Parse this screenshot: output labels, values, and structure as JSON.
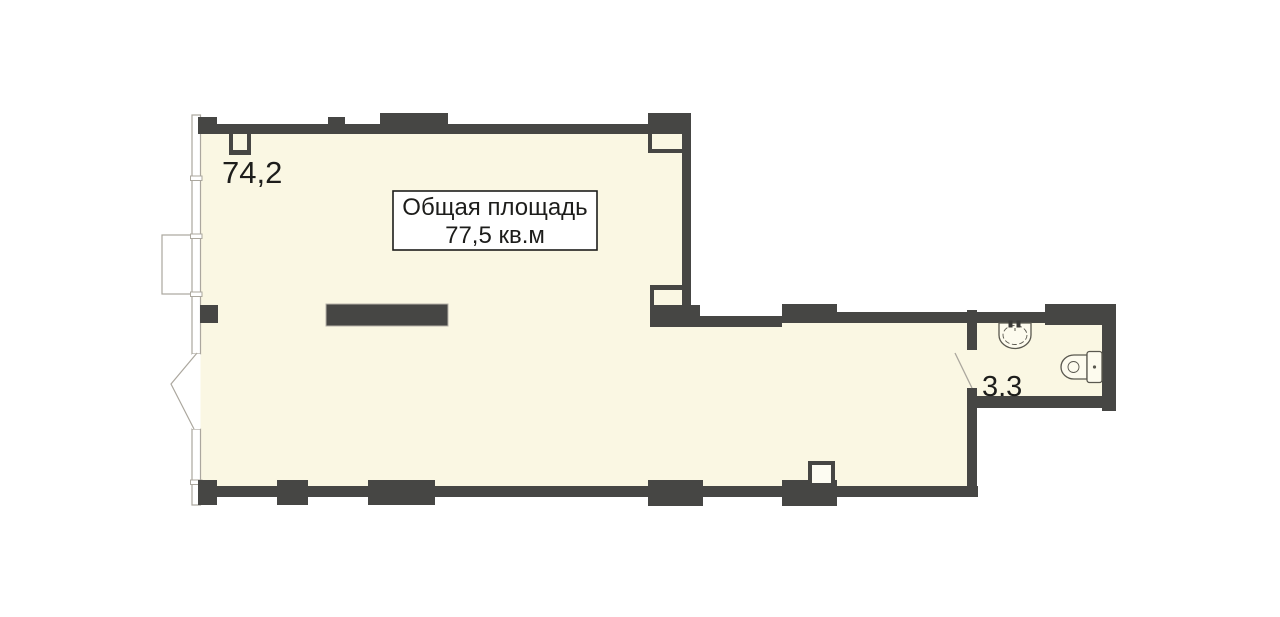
{
  "plan": {
    "main_room": {
      "area_label": "74,2"
    },
    "total_area_box": {
      "line1": "Общая площадь",
      "line2": "77,5 кв.м"
    },
    "bathroom": {
      "area_label": "3.3"
    },
    "icons": {
      "sink": "sink-icon",
      "toilet": "toilet-icon",
      "window": "window-glazing",
      "bay_window": "bay-window",
      "entry_door": "entry-door-swing",
      "bathroom_door": "bathroom-door-swing"
    },
    "colors": {
      "wall": "#464644",
      "floor": "#FAF7E3",
      "background": "#FFFFFF",
      "thin_line": "#ABA79E",
      "fixture_line": "#5A584F",
      "text": "#1D1D1B"
    }
  }
}
